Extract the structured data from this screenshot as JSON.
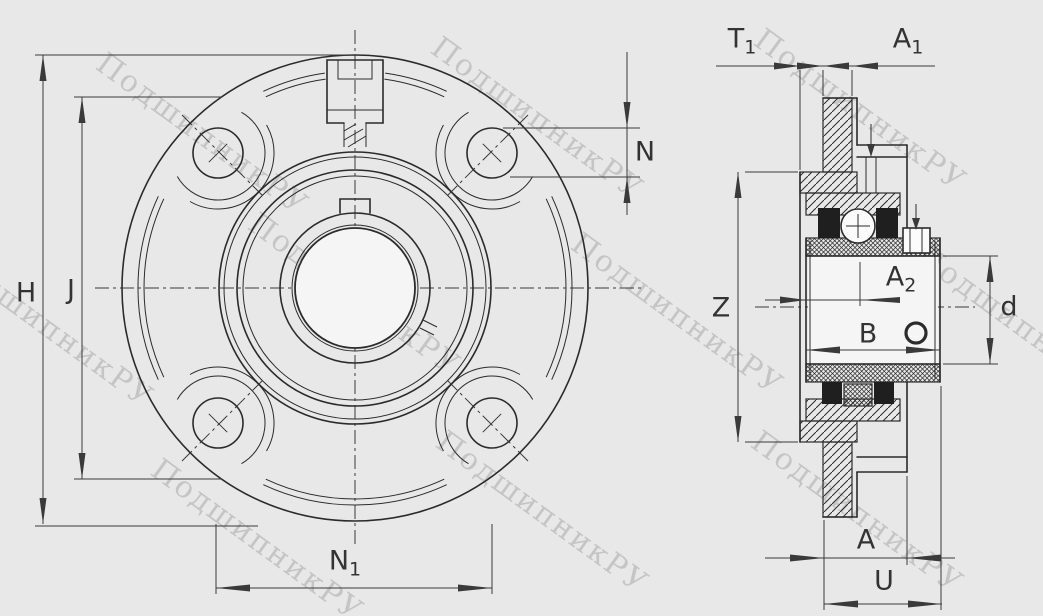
{
  "colors": {
    "background": "#e8e8e8",
    "line": "#2b2b2b",
    "dim_line": "#3a3a3a",
    "watermark": "#bdbdbd",
    "bore_fill": "#f5f5f5",
    "seal_fill": "#1f1f1f",
    "label": "#333333"
  },
  "watermark": {
    "text": "ПодшипникРУ"
  },
  "dimensions": {
    "H": {
      "base": "H",
      "sub": ""
    },
    "J": {
      "base": "J",
      "sub": ""
    },
    "N": {
      "base": "N",
      "sub": ""
    },
    "N1": {
      "base": "N",
      "sub": "1"
    },
    "T1": {
      "base": "T",
      "sub": "1"
    },
    "A1": {
      "base": "A",
      "sub": "1"
    },
    "Z": {
      "base": "Z",
      "sub": ""
    },
    "A2": {
      "base": "A",
      "sub": "2"
    },
    "B": {
      "base": "B",
      "sub": ""
    },
    "d": {
      "base": "d",
      "sub": ""
    },
    "A": {
      "base": "A",
      "sub": ""
    },
    "U": {
      "base": "U",
      "sub": ""
    }
  }
}
